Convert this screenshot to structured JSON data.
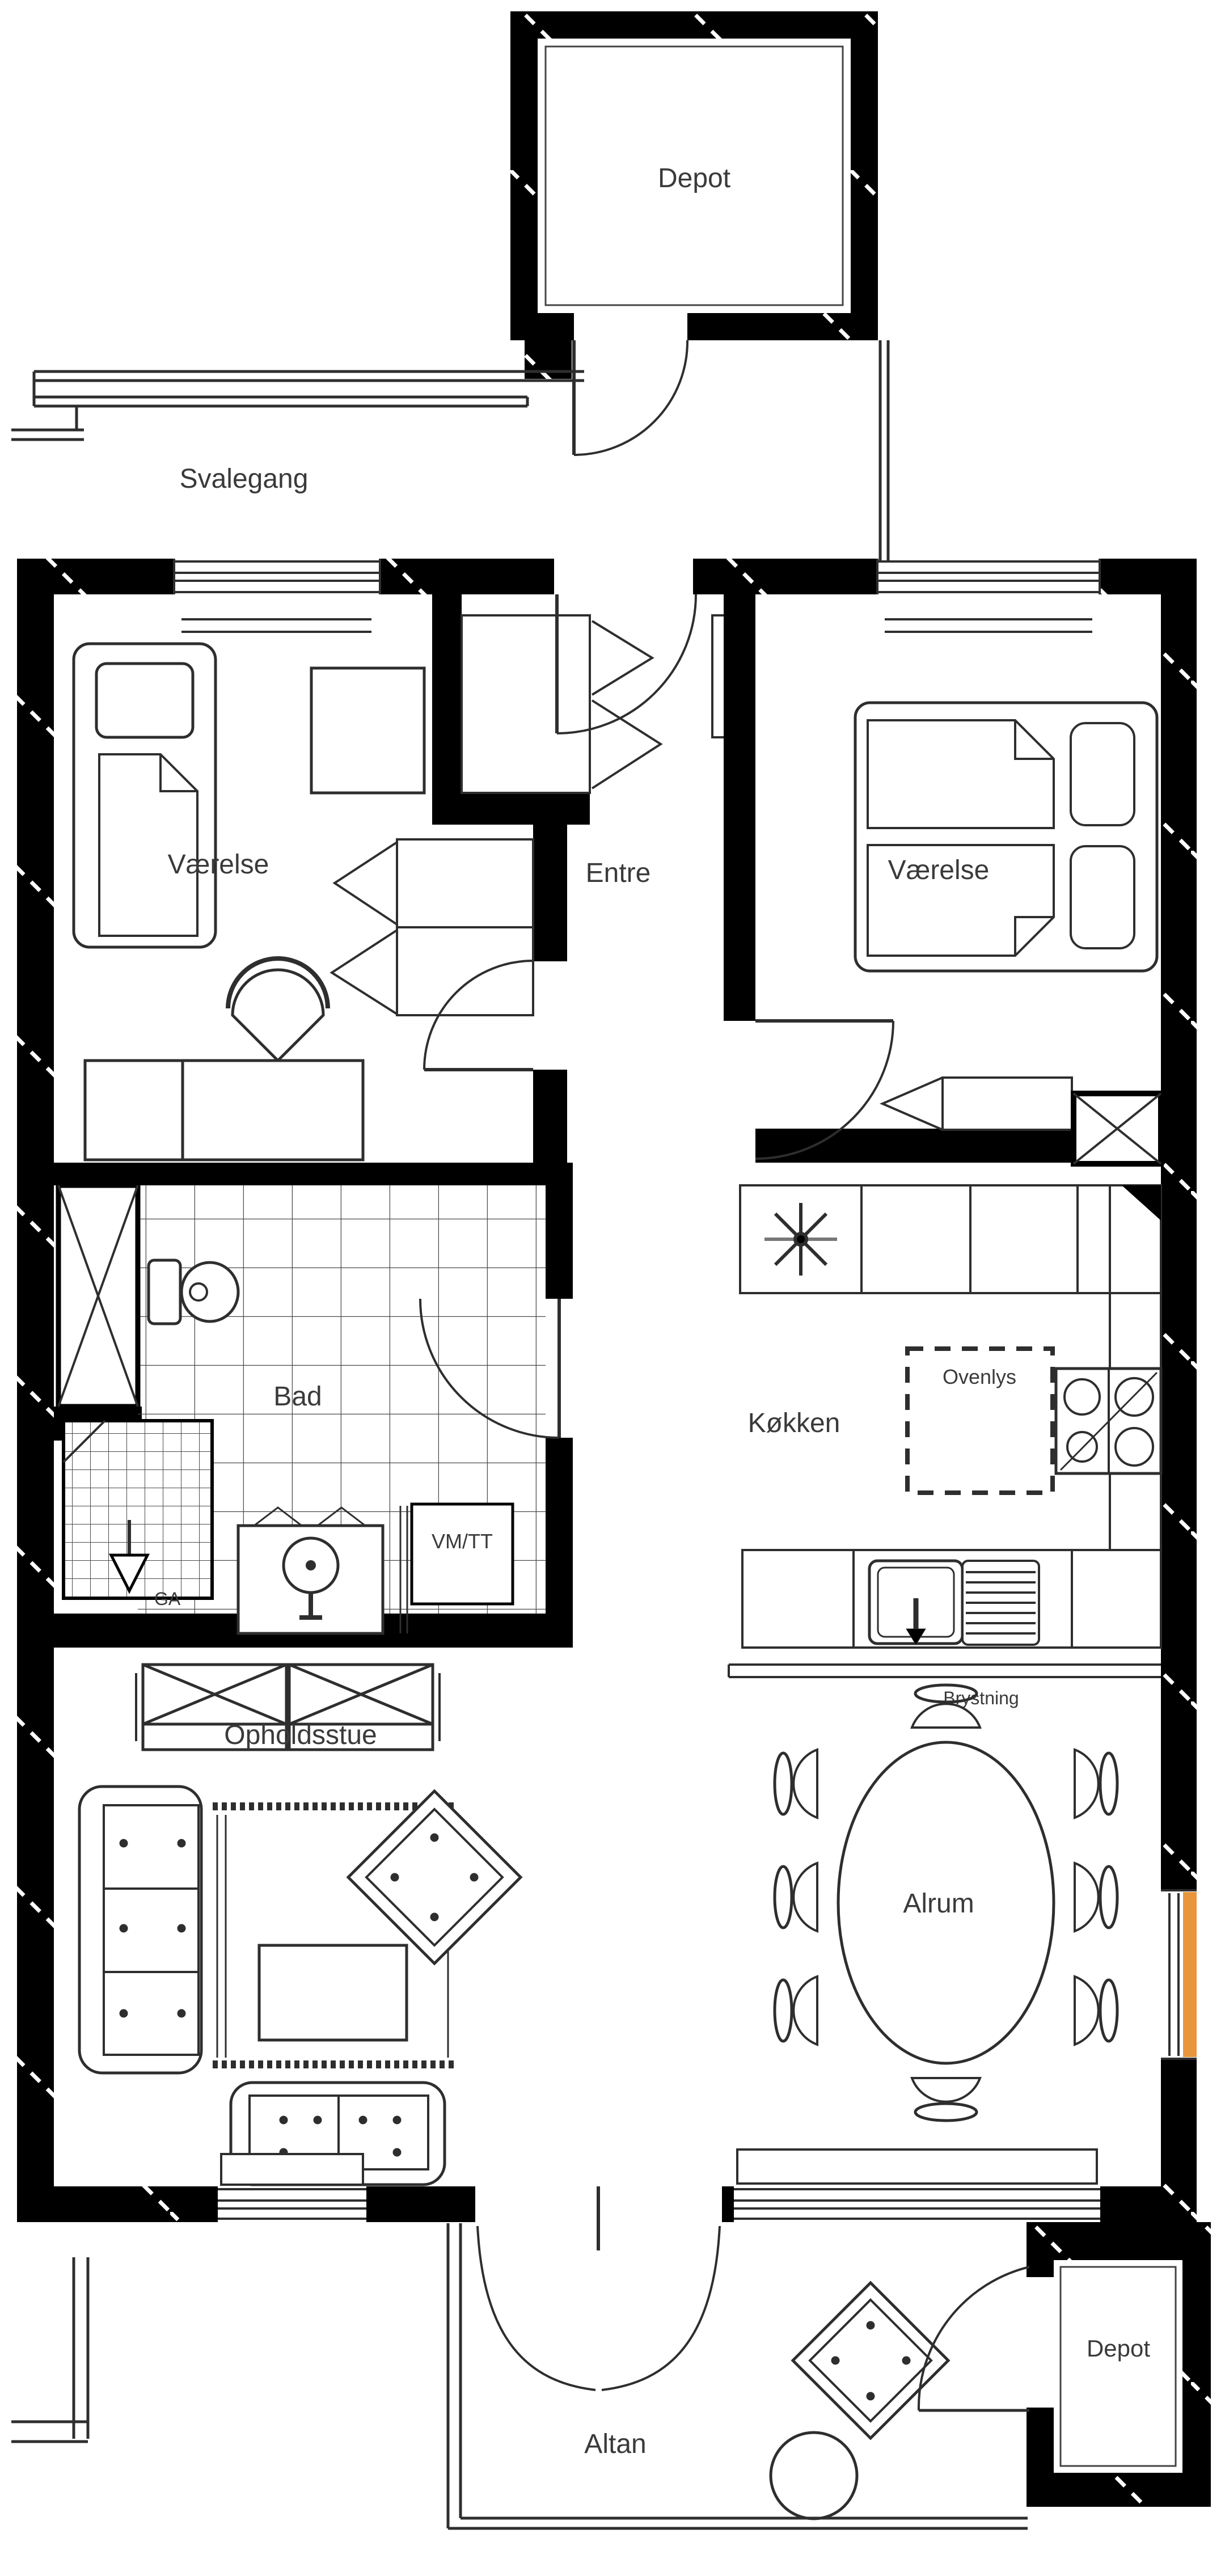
{
  "plan": {
    "type": "floorplan",
    "labels": {
      "depot_top": "Depot",
      "svalegang": "Svalegang",
      "vaerelse_left": "Værelse",
      "entre": "Entre",
      "vaerelse_right": "Værelse",
      "bad": "Bad",
      "vm_tt": "VM/TT",
      "ga": "GA",
      "koekken": "Køkken",
      "ovenlys": "Ovenlys",
      "brystning": "Brystning",
      "opholdsstue": "Opholdsstue",
      "alrum": "Alrum",
      "altan": "Altan",
      "depot_bottom": "Depot"
    },
    "colors": {
      "wall": "#000000",
      "line": "#2e2e2e",
      "label": "#3a3a3a",
      "accent": "#E8953C",
      "background": "#ffffff"
    }
  }
}
